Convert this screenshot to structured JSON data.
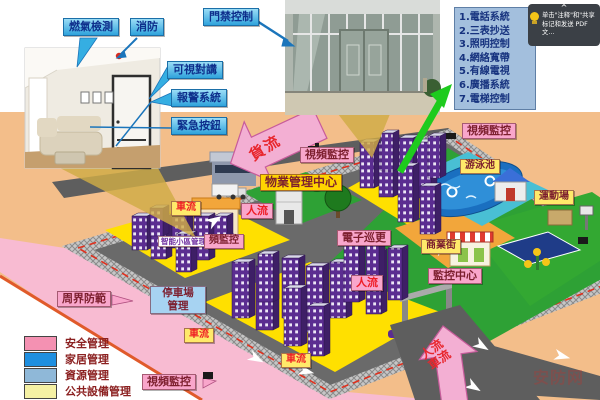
{
  "callouts": {
    "gas": "燃氣檢測",
    "fire": "消防",
    "access_control": "門禁控制",
    "video_intercom": "可視對講",
    "alarm": "報警系統",
    "emergency_button": "緊急按鈕"
  },
  "services_panel": {
    "items": [
      "1.電話系統",
      "2.三表抄送",
      "3.照明控制",
      "4.網絡寬帶",
      "5.有線電視",
      "6.廣播系統",
      "7.電梯控制"
    ]
  },
  "tooltip": {
    "chevron": "^",
    "text_line1": "单击\"注释\"和\"共享",
    "text_line2": "标记和发送 PDF 文…"
  },
  "map_labels": {
    "video_surveillance": "視頻監控",
    "property_center": "物業管理中心",
    "smart_district": "智能小區管理",
    "partial_video": "頻監控",
    "e_patrol": "電子巡更",
    "monitor_center": "監控中心",
    "perimeter": "周界防範",
    "parking_line1": "停車場",
    "parking_line2": "管理",
    "pool": "游泳池",
    "sports": "運動場",
    "mall": "商業街",
    "cargo_flow": "貨流",
    "people_flow": "人流",
    "vehicle_flow": "車流"
  },
  "legend": {
    "items": [
      {
        "label": "安全管理",
        "color": "#F491B2"
      },
      {
        "label": "家居管理",
        "color": "#1E8FE0"
      },
      {
        "label": "資源管理",
        "color": "#8FB8D8"
      },
      {
        "label": "公共設備管理",
        "color": "#F5F1A4"
      }
    ]
  },
  "watermark": "安防网"
}
